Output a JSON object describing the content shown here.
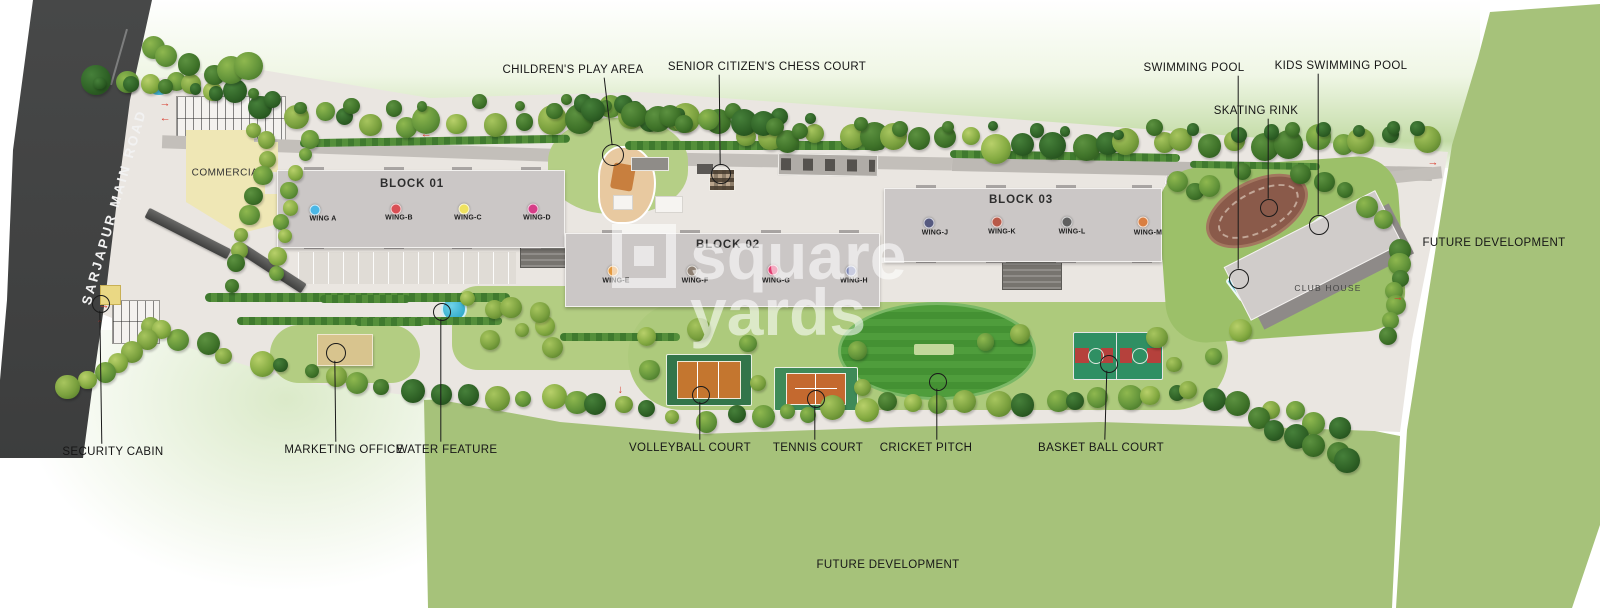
{
  "road_label": "SARJAPUR MAIN ROAD",
  "watermark": {
    "word1": "square",
    "word2": "yards"
  },
  "areas": {
    "commercial": "COMMERCIAL",
    "club_house": "CLUB HOUSE",
    "future_development_east": "FUTURE DEVELOPMENT",
    "future_development_south": "FUTURE DEVELOPMENT"
  },
  "blocks": [
    {
      "label": "BLOCK 01",
      "wings": [
        {
          "label": "WING A",
          "dot_color": "#4ab7e6"
        },
        {
          "label": "WING-B",
          "dot_color": "#d94f55"
        },
        {
          "label": "WING-C",
          "dot_color": "#efe25f"
        },
        {
          "label": "WING-D",
          "dot_color": "#d63d87"
        }
      ]
    },
    {
      "label": "BLOCK 02",
      "wings": [
        {
          "label": "WING-E",
          "dot_color": "#e59a3f"
        },
        {
          "label": "WING-F",
          "dot_color": "#8d7f72"
        },
        {
          "label": "WING-G",
          "dot_color": "#e23a6e"
        },
        {
          "label": "WING-H",
          "dot_color": "#7e87b5"
        }
      ]
    },
    {
      "label": "BLOCK 03",
      "wings": [
        {
          "label": "WING-J",
          "dot_color": "#565a80"
        },
        {
          "label": "WING-K",
          "dot_color": "#b85948"
        },
        {
          "label": "WING-L",
          "dot_color": "#5f5f5f"
        },
        {
          "label": "WING-M",
          "dot_color": "#d97f42"
        }
      ]
    }
  ],
  "callouts": {
    "childrens_play_area": "CHILDREN'S PLAY AREA",
    "senior_chess_court": "SENIOR CITIZEN'S CHESS COURT",
    "swimming_pool": "SWIMMING POOL",
    "kids_swimming_pool": "KIDS SWIMMING POOL",
    "skating_rink": "SKATING RINK",
    "security_cabin": "SECURITY CABIN",
    "marketing_office": "MARKETING OFFICE",
    "water_feature": "WATER FEATURE",
    "volleyball_court": "VOLLEYBALL COURT",
    "tennis_court": "TENNIS COURT",
    "cricket_pitch": "CRICKET PITCH",
    "basketball_court": "BASKET BALL COURT"
  }
}
